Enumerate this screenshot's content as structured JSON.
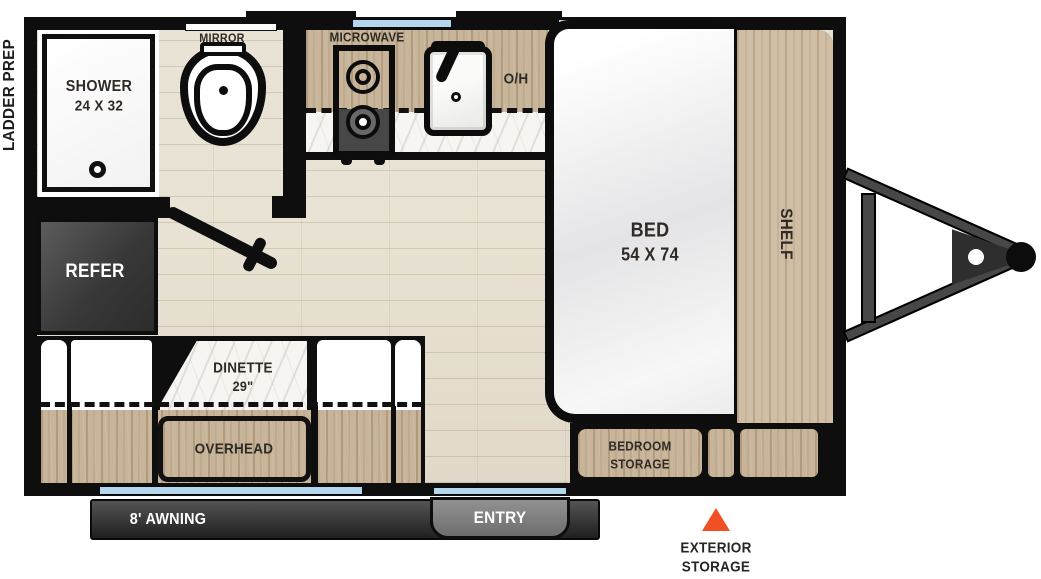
{
  "labels": {
    "ladder_prep": "LADDER PREP",
    "shower_line1": "SHOWER",
    "shower_line2": "24 X 32",
    "mirror": "MIRROR",
    "microwave": "MICROWAVE",
    "overhead_cab": "O/H",
    "refer": "REFER",
    "bed_line1": "BED",
    "bed_line2": "54 X 74",
    "shelf": "SHELF",
    "dinette_line1": "DINETTE",
    "dinette_line2": "29\"",
    "overhead": "OVERHEAD",
    "bedroom_storage_line1": "BEDROOM",
    "bedroom_storage_line2": "STORAGE",
    "awning": "8' AWNING",
    "entry": "ENTRY",
    "exterior_storage_line1": "EXTERIOR",
    "exterior_storage_line2": "STORAGE"
  },
  "colors": {
    "wall": "#0e0e0e",
    "window_glass": "#b5d7ee",
    "floor_wood": "#e9e3d5",
    "cabinet_wood": "#c7b499",
    "shelf_wood": "#cfbda4",
    "marble": "#f6f5f1",
    "appliance_dark": "#454545",
    "awning_dark": "#2a2a2a",
    "entry_gray": "#828282",
    "accent_orange": "#f05023",
    "label_dark": "#2f2a24",
    "label_light": "#ffffff"
  }
}
